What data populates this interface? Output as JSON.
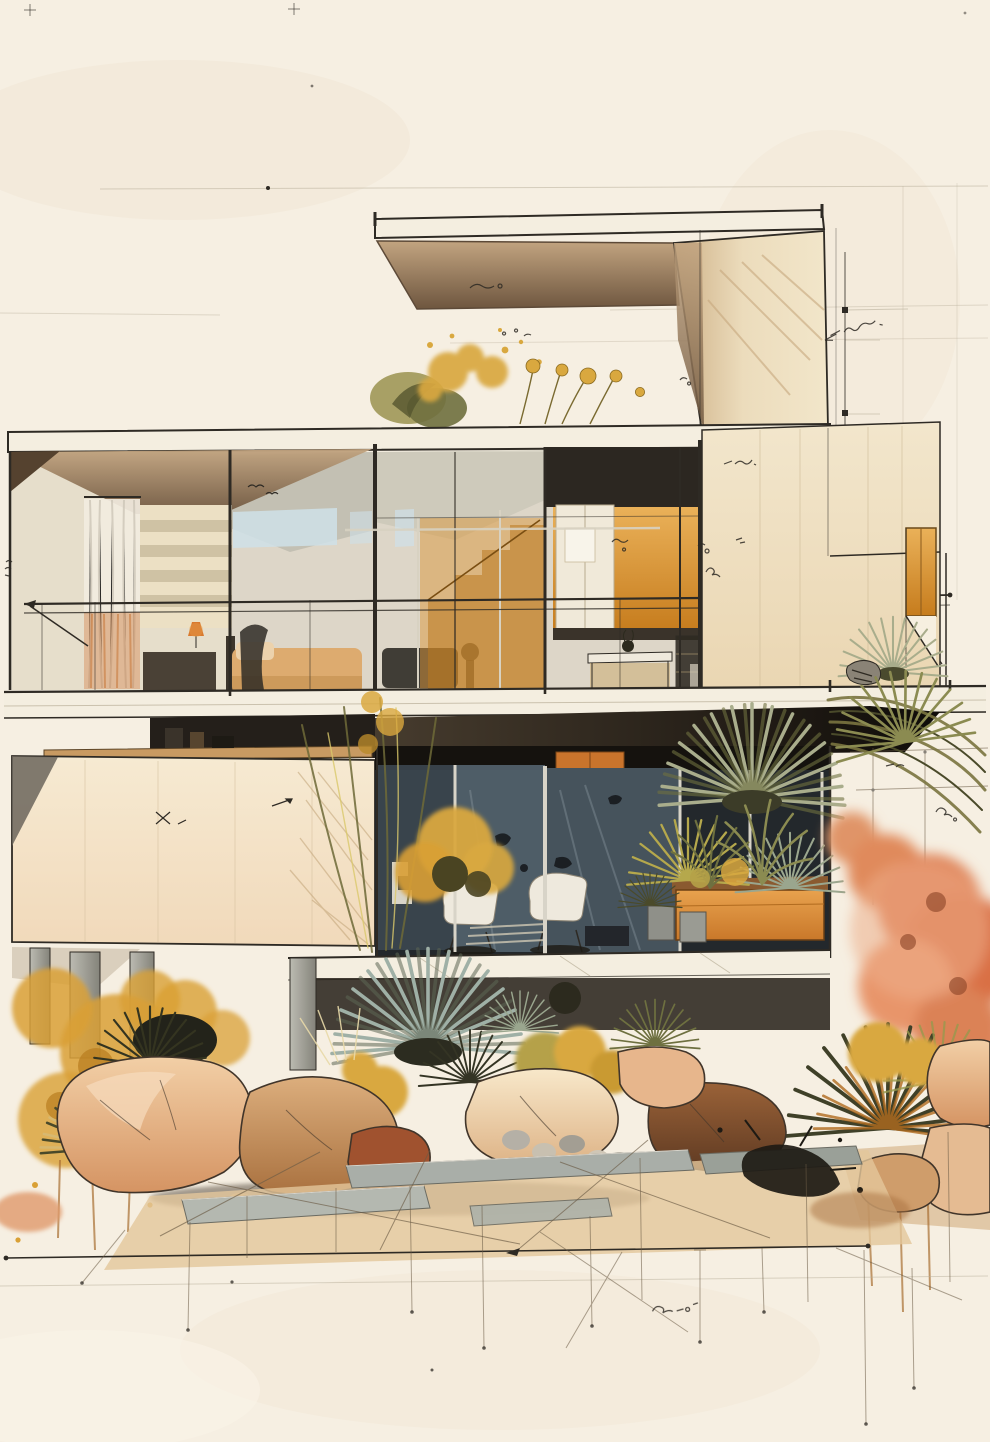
{
  "artwork": {
    "type": "Architectural watercolor sketch",
    "subject": "Modernist two-storey glass house with cantilevered canopy and desert garden",
    "alt": "Ink and watercolor concept drawing of a flat-roofed modernist glass house: cantilevered roof canopy with rooftop planting, upper floor with sheer curtain, bedroom and amber-lit kitchen behind full-height glazing and a balcony rail, a blank cream lower wall on pilotis, dark glazed lounge with white chairs and an orange planter, surrounded by spiky desert plants, ochre washes, a coral shrub, boulders and a stone paver path with fine construction guide lines"
  },
  "palette": {
    "paper": "#f6efe2",
    "stain": "#efe2cd",
    "ink": "#2e2a24",
    "inkSoft": "#6b5b45",
    "guide": "#b9b09c",
    "slab": "#f4eee0",
    "wallCream": "#f0e4c9",
    "glassLight": "#ddd6c8",
    "glassBlue": "#cfe0e8",
    "glassGray": "#b6b3a8",
    "headerDark": "#2c2721",
    "interiorDark": "#23282c",
    "paneBlue": "#51606a",
    "paneBlue2": "#46535c",
    "curtain": "#f2ece0",
    "curtainOrange": "#c97b3e",
    "bedTan": "#ddab6f",
    "woodDesk": "#c89a62",
    "cabinetOrange": "#c9742c",
    "columnGray": "#a9a8a0",
    "chairWhite": "#eee9dd",
    "amberHi": "#eab159",
    "amberLo": "#c67c1d",
    "olive": "#7a7440",
    "oliveDark": "#4a4a2a",
    "inkPlant": "#343420",
    "sage": "#a9ad8c",
    "sageGray": "#9aa68e",
    "goldenSage": "#b5a84c",
    "blueFan": "#9fb0a6",
    "gold": "#d9a83f",
    "ochre": "#d9a035",
    "coral1": "#e09468",
    "coral2": "#d96f45",
    "coralLight": "#ecae8a",
    "pebbleGray": "#aeaaa0",
    "paverTan": "#e3c79b",
    "paverGray": "#a9aea8",
    "splat": "#1d1a14",
    "drip": "#a96f33"
  },
  "scene": {
    "upper_floor": [
      "roof canopy",
      "rooftop planting",
      "sheer curtain",
      "striped shelf wall",
      "bed",
      "table lamp",
      "amber kitchen",
      "dining table",
      "balcony railing"
    ],
    "lower_floor": [
      "blank cream wall",
      "dark glazed lounge",
      "white lounge chairs",
      "orange planter box",
      "concrete pots",
      "pilotis columns"
    ],
    "garden": [
      "yucca fans",
      "golden shrubs",
      "ochre washes",
      "coral shrub",
      "boulders",
      "stone paver path",
      "ink splatter"
    ],
    "drafting": [
      "guide lines",
      "node dots",
      "illegible handwritten notes"
    ]
  }
}
